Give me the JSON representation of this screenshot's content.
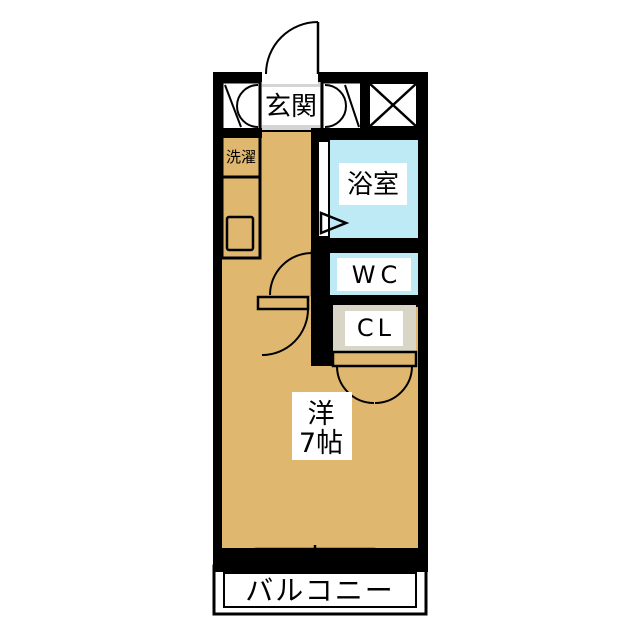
{
  "floor_plan": {
    "rooms": {
      "entrance": {
        "label": "玄関"
      },
      "laundry": {
        "label": "洗濯"
      },
      "bathroom": {
        "label": "浴室"
      },
      "toilet": {
        "label": "WC"
      },
      "closet": {
        "label": "CL"
      },
      "living_room": {
        "label_line1": "洋",
        "label_line2": "7帖"
      },
      "balcony": {
        "label": "バルコニー"
      }
    },
    "colors": {
      "wall": "#000000",
      "wood_floor": "#DFB76F",
      "wet_area_floor": "#BEEAF6",
      "entrance_floor": "#D4D4D4",
      "closet_floor": "#D9D5C7",
      "fixture": "#FFFFFF"
    }
  }
}
